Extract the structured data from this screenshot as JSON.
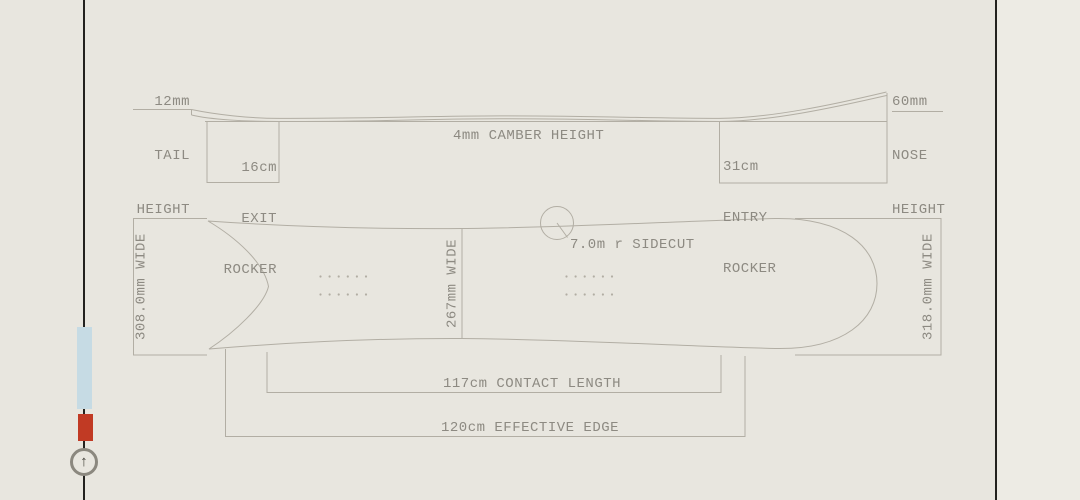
{
  "window": {
    "width": 1080,
    "height": 500
  },
  "colors": {
    "background": "#e8e6df",
    "right_panel": "#edebe4",
    "dark_rule": "#23221f",
    "drawing_line": "#b2aea4",
    "label_text": "#8d8a82",
    "indicator_blue": "#c6dbe4",
    "indicator_red": "#c13a24",
    "button_ring": "#8b887f"
  },
  "diagram": {
    "tail_height": {
      "value": "12mm",
      "line2": "TAIL",
      "line3": "HEIGHT"
    },
    "nose_height": {
      "value": "60mm",
      "line2": "NOSE",
      "line3": "HEIGHT"
    },
    "camber": {
      "label": "4mm CAMBER HEIGHT"
    },
    "exit_rocker": {
      "value": "16cm",
      "line2": "EXIT",
      "line3": "ROCKER"
    },
    "entry_rocker": {
      "value": "31cm",
      "line2": "ENTRY",
      "line3": "ROCKER"
    },
    "widths": {
      "tail": "308.0mm WIDE",
      "waist": "267mm WIDE",
      "nose": "318.0mm WIDE"
    },
    "sidecut": {
      "label": "7.0m r SIDECUT"
    },
    "contact_length": {
      "label": "117cm CONTACT LENGTH"
    },
    "effective_edge": {
      "label": "120cm EFFECTIVE EDGE"
    }
  },
  "scroll_indicator": {
    "arrow_glyph": "↑",
    "icon": "up-arrow-icon"
  }
}
